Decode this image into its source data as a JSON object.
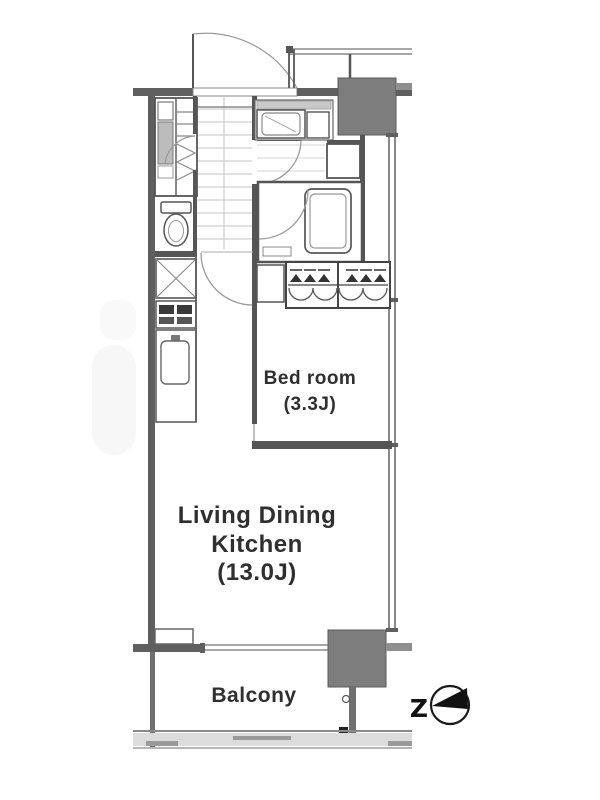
{
  "floorplan": {
    "rooms": {
      "bedroom": {
        "name": "Bed room",
        "area": "(3.3J)"
      },
      "ldk": {
        "line1": "Living Dining",
        "line2": "Kitchen",
        "area": "(13.0J)"
      },
      "balcony": {
        "name": "Balcony"
      }
    },
    "compass": {
      "letter": "Z"
    },
    "colors": {
      "wall": "#5f5f5f",
      "pillar": "#7d7d7d",
      "line_dark": "#555555",
      "line_light": "#9a9a9a",
      "text": "#2f2f2f",
      "background": "#ffffff"
    },
    "fixtures": {
      "entrance_door": "entrance-door",
      "toilet": "toilet",
      "bathtub": "bathtub",
      "washing_machine": "washing-machine-pan",
      "wash_basin": "wash-basin",
      "closet": "closet-with-hangers",
      "refrigerator": "refrigerator-space",
      "stove": "stove",
      "sink": "kitchen-sink",
      "north_arrow": "north-arrow-compass"
    }
  }
}
